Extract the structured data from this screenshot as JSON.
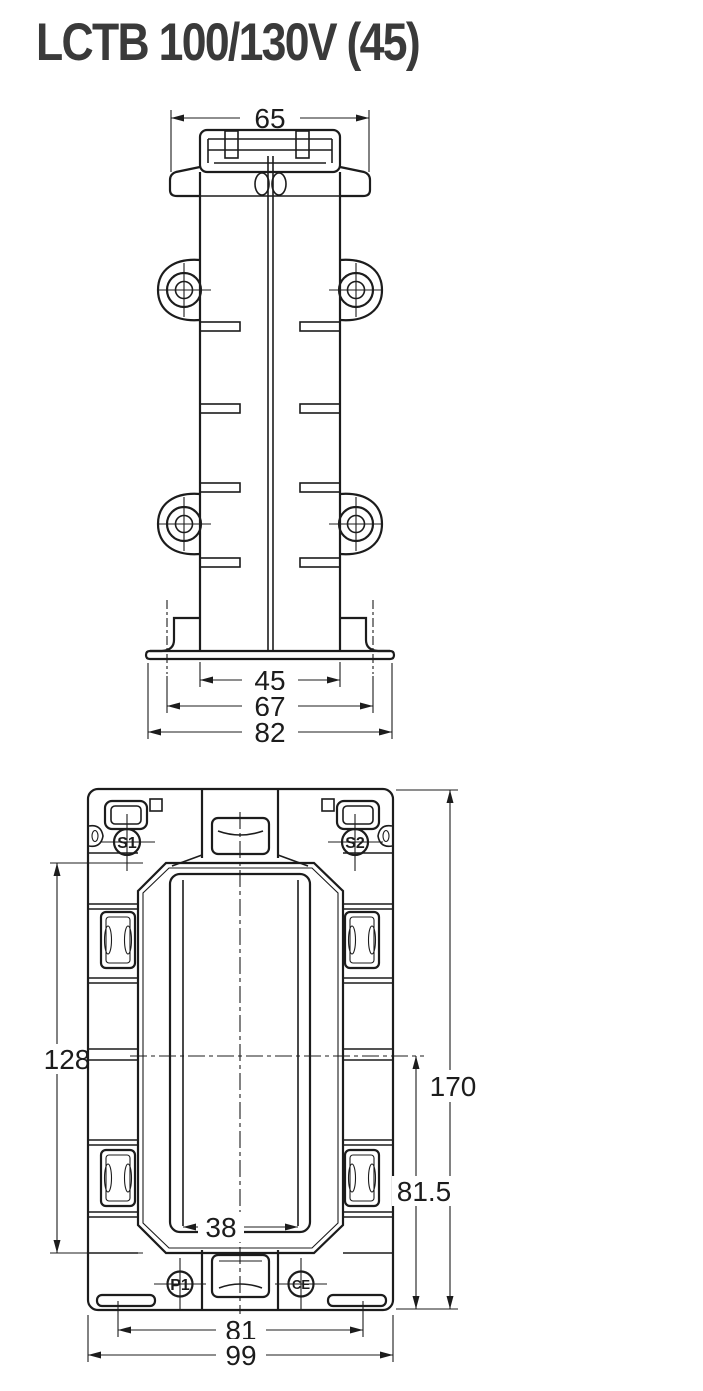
{
  "title": "LCTB 100/130V (45)",
  "colors": {
    "line": "#1c1c1c",
    "title_text": "#3a3a3a",
    "background": "#ffffff"
  },
  "views": {
    "side": {
      "dimensions": {
        "d65": "65",
        "d45": "45",
        "d67": "67",
        "d82": "82"
      }
    },
    "front": {
      "dimensions": {
        "d128": "128",
        "d170": "170",
        "d81_5": "81.5",
        "d38": "38",
        "d81": "81",
        "d99": "99"
      },
      "labels": {
        "s1": "S1",
        "s2": "S2",
        "p1": "P1",
        "ce": "CE"
      }
    }
  }
}
